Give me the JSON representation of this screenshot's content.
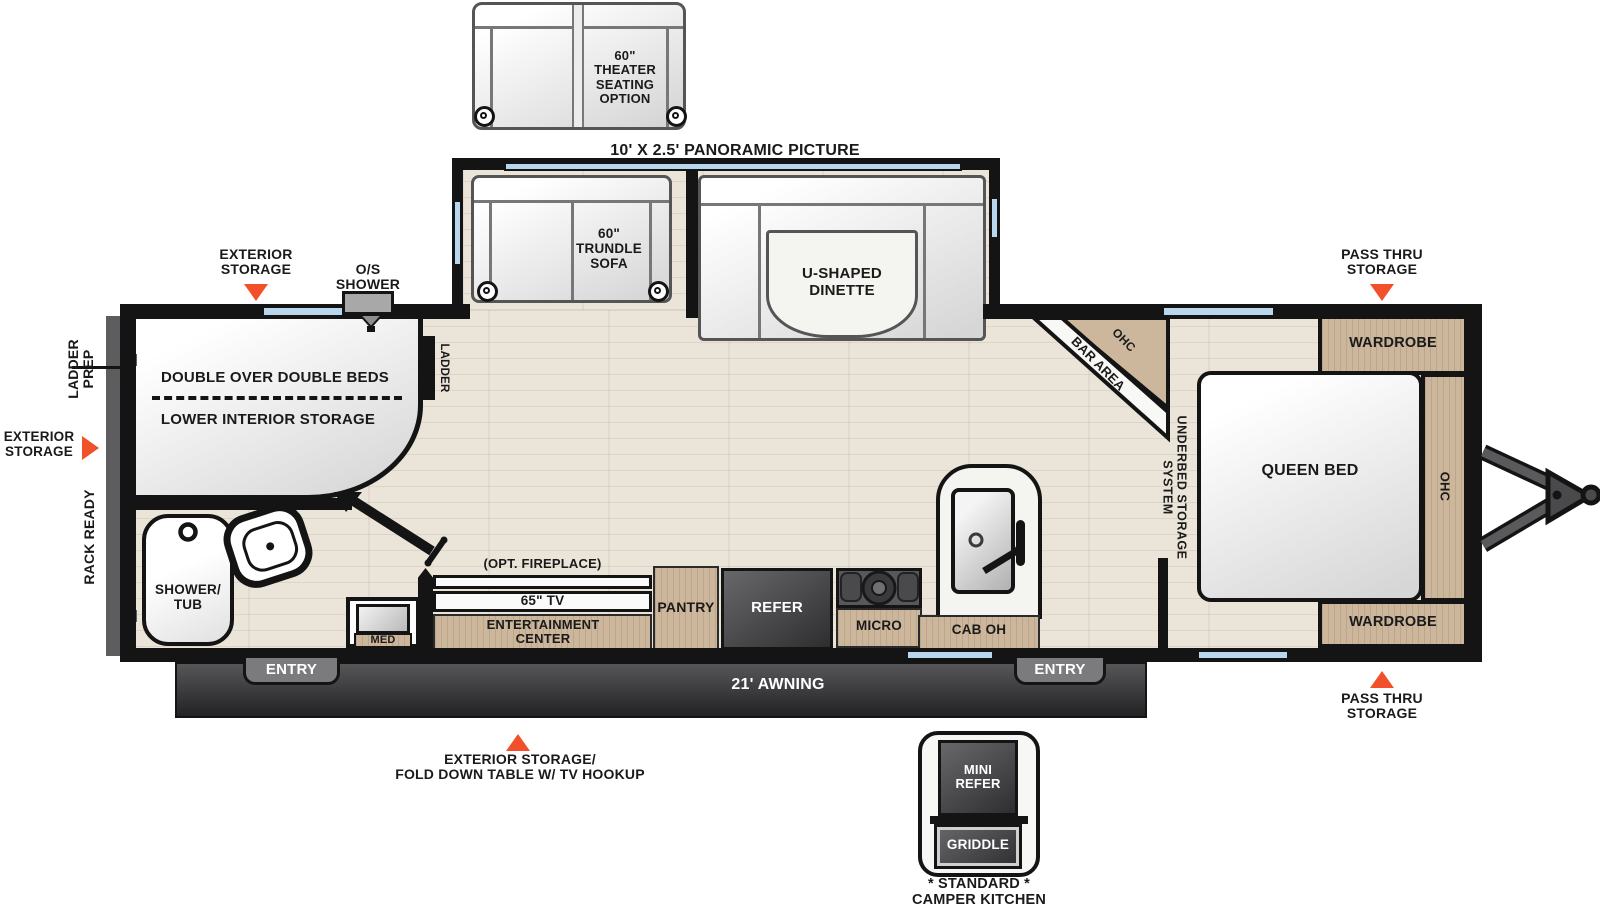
{
  "colors": {
    "wall": "#141414",
    "accent_orange": "#f1502a",
    "wood_cabinet": "#cdb79c",
    "window_glass": "#b8d7ee",
    "appliance_dark": "#3a3a3c",
    "floor_wood": "#eae4d9",
    "awning_dark": "#39393b"
  },
  "options": {
    "theater_seating": "60\"\nTHEATER\nSEATING\nOPTION",
    "panoramic_picture": "10' X 2.5' PANORAMIC PICTURE",
    "fireplace": "(OPT. FIREPLACE)"
  },
  "slideout": {
    "trundle_sofa": "60\"\nTRUNDLE\nSOFA",
    "dinette": "U-SHAPED\nDINETTE"
  },
  "exterior": {
    "storage_top": "EXTERIOR\nSTORAGE",
    "os_shower": "O/S\nSHOWER",
    "pass_thru_top": "PASS THRU\nSTORAGE",
    "pass_thru_bottom": "PASS THRU\nSTORAGE",
    "ladder_prep": "LADDER\nPREP",
    "storage_left": "EXTERIOR\nSTORAGE",
    "rack_ready": "RACK READY",
    "awning": "21' AWNING",
    "entry_left": "ENTRY",
    "entry_right": "ENTRY",
    "storage_bottom": "EXTERIOR STORAGE/\nFOLD DOWN TABLE W/ TV HOOKUP"
  },
  "front_bedroom": {
    "beds": "DOUBLE OVER DOUBLE BEDS",
    "storage": "LOWER INTERIOR STORAGE",
    "ladder": "LADDER"
  },
  "bathroom": {
    "shower_tub": "SHOWER/\nTUB",
    "med": "MED"
  },
  "living": {
    "tv": "65\" TV",
    "ent_center": "ENTERTAINMENT\nCENTER",
    "pantry": "PANTRY"
  },
  "kitchen": {
    "refer": "REFER",
    "micro": "MICRO",
    "cab_oh": "CAB OH",
    "bar_area": "BAR AREA",
    "bar_ohc": "OHC"
  },
  "bedroom": {
    "queen_bed": "QUEEN BED",
    "wardrobe_top": "WARDROBE",
    "wardrobe_bottom": "WARDROBE",
    "ohc": "OHC",
    "underbed": "UNDERBED STORAGE SYSTEM"
  },
  "camper_kitchen": {
    "mini_refer": "MINI\nREFER",
    "griddle": "GRIDDLE",
    "caption": "* STANDARD *\nCAMPER KITCHEN"
  }
}
